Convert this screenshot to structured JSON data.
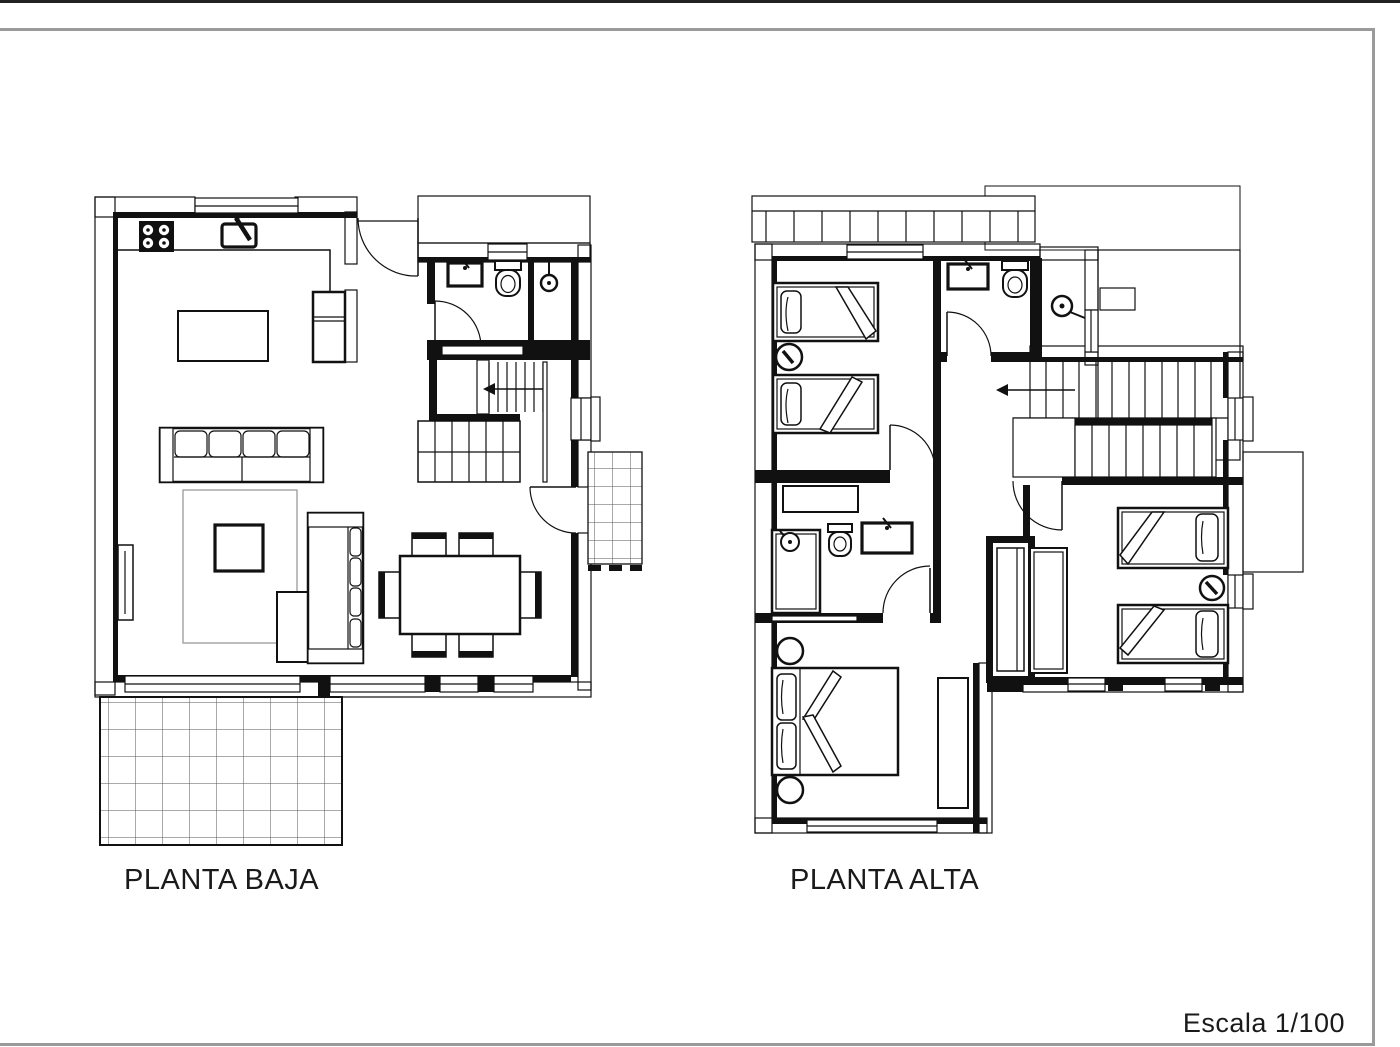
{
  "title_block": {
    "scale_label": "Escala 1/100"
  },
  "page": {
    "background_color": "#ffffff",
    "frame_color": "#9a9a9a",
    "ink_color": "#111111",
    "drawing_type": "two-storey house floor plans"
  },
  "plans": [
    {
      "id": "planta-baja",
      "label": "PLANTA BAJA",
      "floor": "ground floor",
      "drawn_symbols": [
        "kitchen-stove-icon",
        "kitchen-sink-icon",
        "kitchen-island",
        "wall-cabinet",
        "sofa",
        "chaise-sofa",
        "ottoman",
        "coffee-table",
        "rug",
        "radiator",
        "dining-table",
        "dining-chairs-6",
        "bathroom-sink-icon",
        "toilet-icon",
        "shower-icon",
        "staircase-up",
        "entrance-door-arc",
        "interior-door-arcs",
        "window-openings",
        "tiled-terrace",
        "tiled-porch",
        "hatched-exterior-walls"
      ]
    },
    {
      "id": "planta-alta",
      "label": "PLANTA ALTA",
      "floor": "upper floor",
      "drawn_symbols": [
        "balcony-railing",
        "roof-outline",
        "open-terraces",
        "single-bed-x2-front-bedroom",
        "single-bed-x2-rear-bedroom",
        "double-bed-master",
        "nightstand-lamp-icons",
        "bedside-stools",
        "dresser",
        "desk",
        "wardrobes",
        "linen-closet",
        "bathroom-sink-icons",
        "toilet-icons",
        "shower-tray",
        "shower-head-icon",
        "staircase-with-direction-arrow",
        "interior-door-arcs",
        "window-openings",
        "hatched-exterior-walls"
      ]
    }
  ]
}
